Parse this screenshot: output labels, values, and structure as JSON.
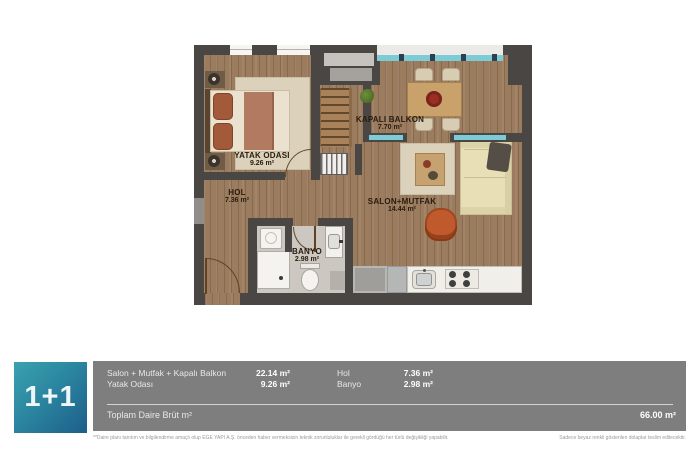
{
  "plan": {
    "rooms": [
      {
        "name": "YATAK ODASI",
        "area": "9.26 m²"
      },
      {
        "name": "KAPALI BALKON",
        "area": "7.70 m²"
      },
      {
        "name": "HOL",
        "area": "7.36 m²"
      },
      {
        "name": "SALON+MUTFAK",
        "area": "14.44 m²"
      },
      {
        "name": "BANYO",
        "area": "2.98 m²"
      }
    ]
  },
  "info": {
    "type_label": "1+1",
    "rows": [
      {
        "label": "Salon + Mutfak + Kapalı Balkon",
        "value": "22.14 m²"
      },
      {
        "label": "Yatak Odası",
        "value": "9.26 m²"
      },
      {
        "label": "Hol",
        "value": "7.36 m²"
      },
      {
        "label": "Banyo",
        "value": "2.98 m²"
      }
    ],
    "total_label": "Toplam Daire Brüt m²",
    "total_value": "66.00 m²"
  },
  "footnotes": {
    "left": "**Daire planı tanıtım ve bilgilendirme amaçlı olup EGE YAPI A.Ş. önceden haber vermeksizin teknik zorunluluklar ile gerekli gördüğü her türlü değişikliği yapabilir.",
    "right": "Sadece beyaz renkli gösterilen dolaplar teslim edilecektir."
  },
  "colors": {
    "accent_teal": "#3aa2ae",
    "accent_blue": "#1d5e89",
    "panel_gray": "#7e7e7e",
    "wall_dark": "#4a4643",
    "wood_floor": "#9b7c5e",
    "glass_teal": "#7ccbd6",
    "sofa_cream": "#e8dfb6",
    "armchair_rust": "#bf5a2c"
  }
}
